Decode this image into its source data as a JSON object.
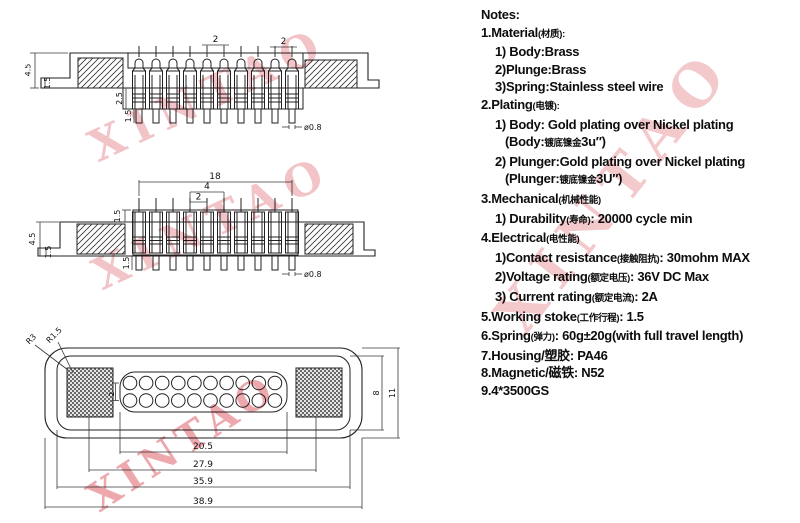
{
  "watermark": {
    "text": "XINTAO"
  },
  "notes": {
    "lines": [
      {
        "indent": 0,
        "seg": [
          {
            "t": "Notes:"
          }
        ]
      },
      {
        "indent": 0,
        "seg": [
          {
            "t": "1.Material"
          },
          {
            "t": "(材质):",
            "cn": true
          }
        ]
      },
      {
        "indent": 14,
        "seg": [
          {
            "t": "1) Body:Brass"
          }
        ]
      },
      {
        "indent": 14,
        "seg": [
          {
            "t": "2)Plunge:Brass"
          }
        ]
      },
      {
        "indent": 14,
        "seg": [
          {
            "t": "3)Spring:Stainless steel wire"
          }
        ]
      },
      {
        "indent": 0,
        "seg": [
          {
            "t": "2.Plating"
          },
          {
            "t": "(电镀):",
            "cn": true
          }
        ]
      },
      {
        "indent": 14,
        "seg": [
          {
            "t": "1) Body: Gold plating over Nickel plating"
          }
        ]
      },
      {
        "indent": 24,
        "seg": [
          {
            "t": "(Body:"
          },
          {
            "t": "镀底镍金",
            "cn": true
          },
          {
            "t": "3u″)"
          }
        ]
      },
      {
        "indent": 14,
        "seg": [
          {
            "t": "2) Plunger:Gold plating over Nickel plating"
          }
        ]
      },
      {
        "indent": 24,
        "seg": [
          {
            "t": "(Plunger:"
          },
          {
            "t": "镀底镍金",
            "cn": true
          },
          {
            "t": "3U″)"
          }
        ]
      },
      {
        "indent": 0,
        "seg": [
          {
            "t": "3.Mechanical"
          },
          {
            "t": "(机械性能)",
            "cn": true
          }
        ]
      },
      {
        "indent": 14,
        "seg": [
          {
            "t": "1) Durability"
          },
          {
            "t": "(寿命)",
            "cn": true
          },
          {
            "t": ": 20000 cycle  min"
          }
        ]
      },
      {
        "indent": 0,
        "seg": [
          {
            "t": "4.Electrical"
          },
          {
            "t": "(电性能)",
            "cn": true
          }
        ]
      },
      {
        "indent": 14,
        "seg": [
          {
            "t": "1)Contact resistance"
          },
          {
            "t": "(接触阻抗)",
            "cn": true
          },
          {
            "t": ": 30mohm MAX"
          }
        ]
      },
      {
        "indent": 14,
        "seg": [
          {
            "t": "2)Voltage rating"
          },
          {
            "t": "(额定电压)",
            "cn": true
          },
          {
            "t": ": 36V DC Max"
          }
        ]
      },
      {
        "indent": 14,
        "seg": [
          {
            "t": "3) Current rating"
          },
          {
            "t": "(额定电流)",
            "cn": true
          },
          {
            "t": ": 2A"
          }
        ]
      },
      {
        "indent": 0,
        "seg": [
          {
            "t": "5.Working stoke"
          },
          {
            "t": "(工作行程)",
            "cn": true
          },
          {
            "t": ": 1.5"
          }
        ]
      },
      {
        "indent": 0,
        "seg": [
          {
            "t": "6.Spring"
          },
          {
            "t": "(弹力)",
            "cn": true
          },
          {
            "t": ": 60g±20g"
          },
          {
            "t": "(with full travel length)"
          }
        ]
      },
      {
        "indent": 0,
        "seg": [
          {
            "t": "7.Housing/塑胶: PA46"
          }
        ]
      },
      {
        "indent": 0,
        "seg": [
          {
            "t": "8.Magnetic/磁铁: N52"
          }
        ]
      },
      {
        "indent": 0,
        "seg": [
          {
            "t": "9.4*3500GS"
          }
        ]
      }
    ]
  },
  "drawings": {
    "side_view_extended": {
      "pin_count": 10,
      "dims": {
        "pitch_a": "2",
        "pitch_b": "2",
        "overall_height": "4.5",
        "flange_step": "1.5",
        "boss_depth": "2.5",
        "tail_length": "1.5",
        "tail_diameter": "ø0.8"
      }
    },
    "side_view_compressed": {
      "pin_count": 10,
      "dims": {
        "span": "18",
        "pitch_double": "4",
        "pitch": "2",
        "boss_height": "1.5",
        "overall_height": "4.5",
        "flange_step": "1.5",
        "tail_length": "1.5",
        "tail_diameter": "ø0.8"
      }
    },
    "top_view": {
      "pin_rows": 2,
      "pin_cols": 10,
      "dims": {
        "corner_radius_outer": "R3",
        "corner_radius_inner": "R1.5",
        "row_pitch": "2",
        "pin_span": "20.5",
        "magnet_span": "27.9",
        "inner_width": "35.9",
        "outer_width": "38.9",
        "inner_height": "8",
        "outer_height": "11"
      }
    }
  }
}
